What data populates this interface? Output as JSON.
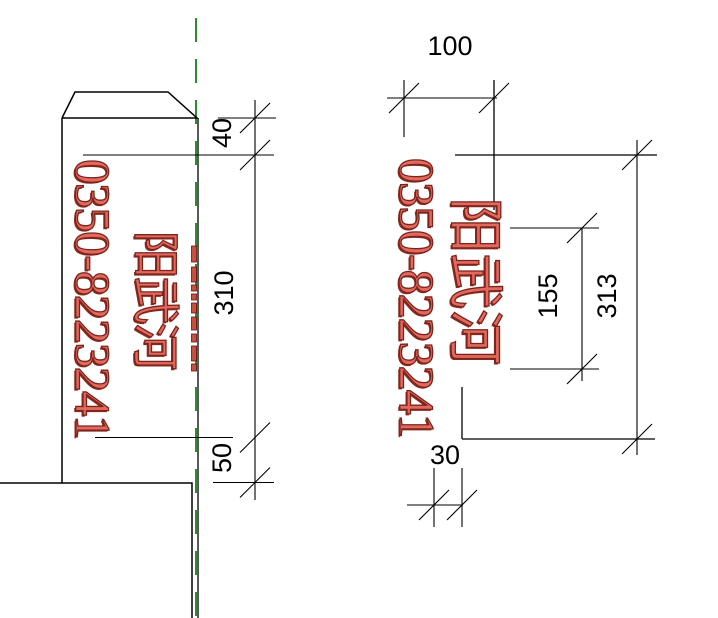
{
  "drawing_title": "river-marker-post-detail",
  "labels": {
    "phone": "0350-8223241",
    "river_name": "阳武河"
  },
  "side_view": {
    "phone": "0350-8223241",
    "river": "阳武河",
    "dims": [
      {
        "id": "top-offset",
        "label": "40"
      },
      {
        "id": "text-length",
        "label": "310"
      },
      {
        "id": "bottom-offset",
        "label": "50"
      }
    ]
  },
  "front_view": {
    "phone": "0350-8223241",
    "river": "阳武河",
    "dims": [
      {
        "id": "width",
        "label": "100"
      },
      {
        "id": "inner-height",
        "label": "155"
      },
      {
        "id": "total-height",
        "label": "313"
      },
      {
        "id": "side-offset",
        "label": "30"
      }
    ]
  },
  "colors": {
    "line": "#000000",
    "centerline_green": "#2e8b2e",
    "text_fill_red": "#e2695e",
    "text_outline_red": "#7c241c",
    "ground_base": "#d8cdc0"
  }
}
